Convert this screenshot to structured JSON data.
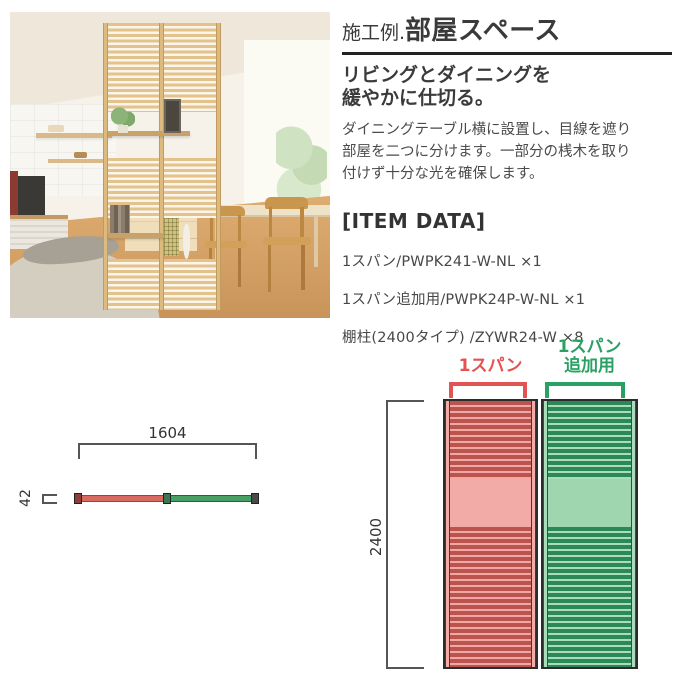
{
  "header": {
    "title_prefix": "施工例.",
    "title_main": "部屋スペース",
    "subtitle_line1": "リビングとダイニングを",
    "subtitle_line2": "緩やかに仕切る。",
    "description_lines": [
      "ダイニングテーブル横に設置し、目線を遮り",
      "部屋を二つに分けます。一部分の桟木を取り",
      "付けず十分な光を確保します。"
    ]
  },
  "item_data": {
    "heading": "[ITEM DATA]",
    "items": [
      "1スパン/PWPK241-W-NL ×1",
      "1スパン追加用/PWPK24P-W-NL ×1",
      "棚柱(2400タイプ) /ZYWR24-W ×8"
    ]
  },
  "diagram_top_view": {
    "width_label": "1604",
    "depth_label": "42",
    "span1_color": "#d9685e",
    "span2_color": "#46a066"
  },
  "diagram_front_view": {
    "height_label": "2400",
    "span1_label": "1スパン",
    "span2_label_line1": "1スパン",
    "span2_label_line2": "追加用",
    "span1_color": "#e25352",
    "span2_color": "#2aa164",
    "span1_slat_color": "#bb544e",
    "span1_bg_color": "#f0a8a4",
    "span2_slat_color": "#2c8857",
    "span2_bg_color": "#a9dcba"
  }
}
